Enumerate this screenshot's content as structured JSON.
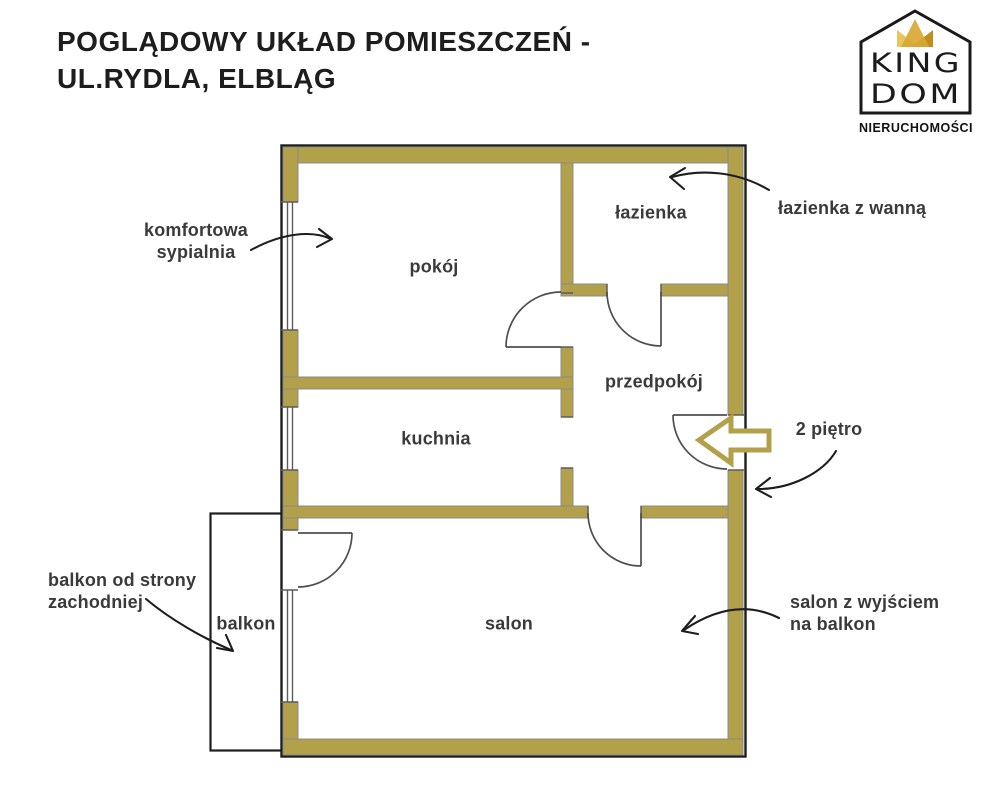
{
  "title": {
    "line1": "POGLĄDOWY UKŁAD POMIESZCZEŃ -",
    "line2": "UL.RYDLA, ELBLĄG"
  },
  "logo": {
    "brand_line1": "KING",
    "brand_line2": "DOM",
    "tagline": "NIERUCHOMOŚCI"
  },
  "rooms": {
    "pokoj": "pokój",
    "lazienka": "łazienka",
    "przedpokoj": "przedpokój",
    "kuchnia": "kuchnia",
    "salon": "salon",
    "balkon": "balkon"
  },
  "annotations": {
    "bedroom": {
      "line1": "komfortowa",
      "line2": "sypialnia"
    },
    "bathroom": "łazienka z wanną",
    "floor": "2 piętro",
    "balcony": {
      "line1": "balkon od strony",
      "line2": "zachodniej"
    },
    "living": {
      "line1": "salon z wyjściem",
      "line2": "na balkon"
    }
  },
  "colors": {
    "wall": "#b2a04a",
    "ink": "#1d1d1d",
    "label": "#3a3a3a",
    "door_line": "#4e4e4e",
    "window_line": "#5c5c5c",
    "wall_edge": "#8b8b8b",
    "crown_gold": "#d9a733",
    "crown_light": "#e8c55e",
    "crown_dark": "#c28f1e"
  }
}
